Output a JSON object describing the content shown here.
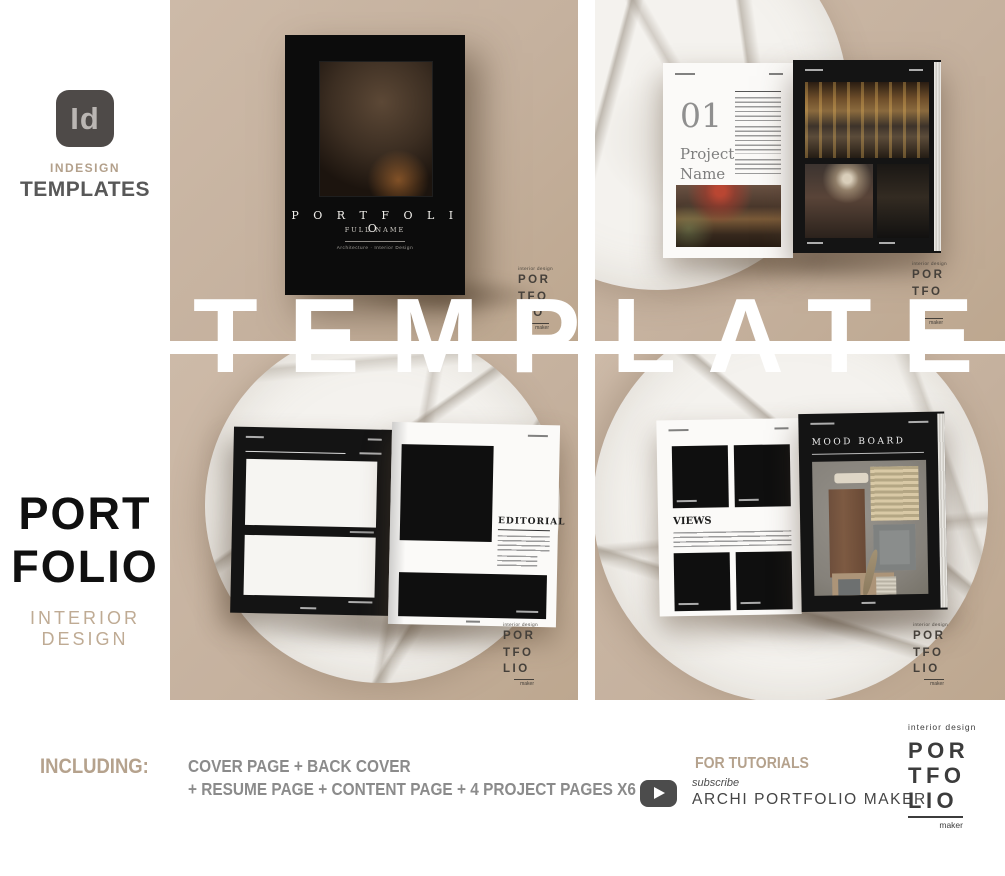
{
  "badge": {
    "logo_text": "Id",
    "line1": "INDESIGN",
    "line2": "TEMPLATES"
  },
  "overlay": {
    "big_text": "TEMPLATES"
  },
  "left_column": {
    "title_line1": "PORT",
    "title_line2": "FOLIO",
    "subtitle": "INTERIOR DESIGN"
  },
  "cover_mockup": {
    "title": "PORTFOLIO",
    "subtitle": "FULL NAME",
    "tagline": "Architecture · Interior Design"
  },
  "project_spread": {
    "number": "01",
    "title_line1": "Project",
    "title_line2": "Name"
  },
  "editorial_spread": {
    "heading": "EDITORIAL"
  },
  "views_spread": {
    "heading": "VIEWS"
  },
  "mood_spread": {
    "heading": "MOOD BOARD"
  },
  "brand_logo": {
    "top_line": "interior design",
    "row1": "POR",
    "row2": "TFO",
    "row3": "LIO",
    "bottom_line": "maker"
  },
  "footer": {
    "including_label": "INCLUDING:",
    "features_line1": "COVER PAGE + BACK COVER",
    "features_line2": "+ RESUME PAGE + CONTENT PAGE + 4 PROJECT PAGES X6",
    "tutorials_label": "FOR TUTORIALS",
    "subscribe_label": "subscribe",
    "channel_name": "ARCHI PORTFOLIO MAKER",
    "youtube_icon": "youtube-play-icon"
  },
  "colors": {
    "panel_tan": "#c6b2a0",
    "accent_tan": "#b3a08b",
    "text_dark": "#4a4a4a",
    "text_gray": "#8b8b8b",
    "page_black": "#141414",
    "marble_white": "#f4f2ee",
    "overlay_white": "#ffffff"
  }
}
